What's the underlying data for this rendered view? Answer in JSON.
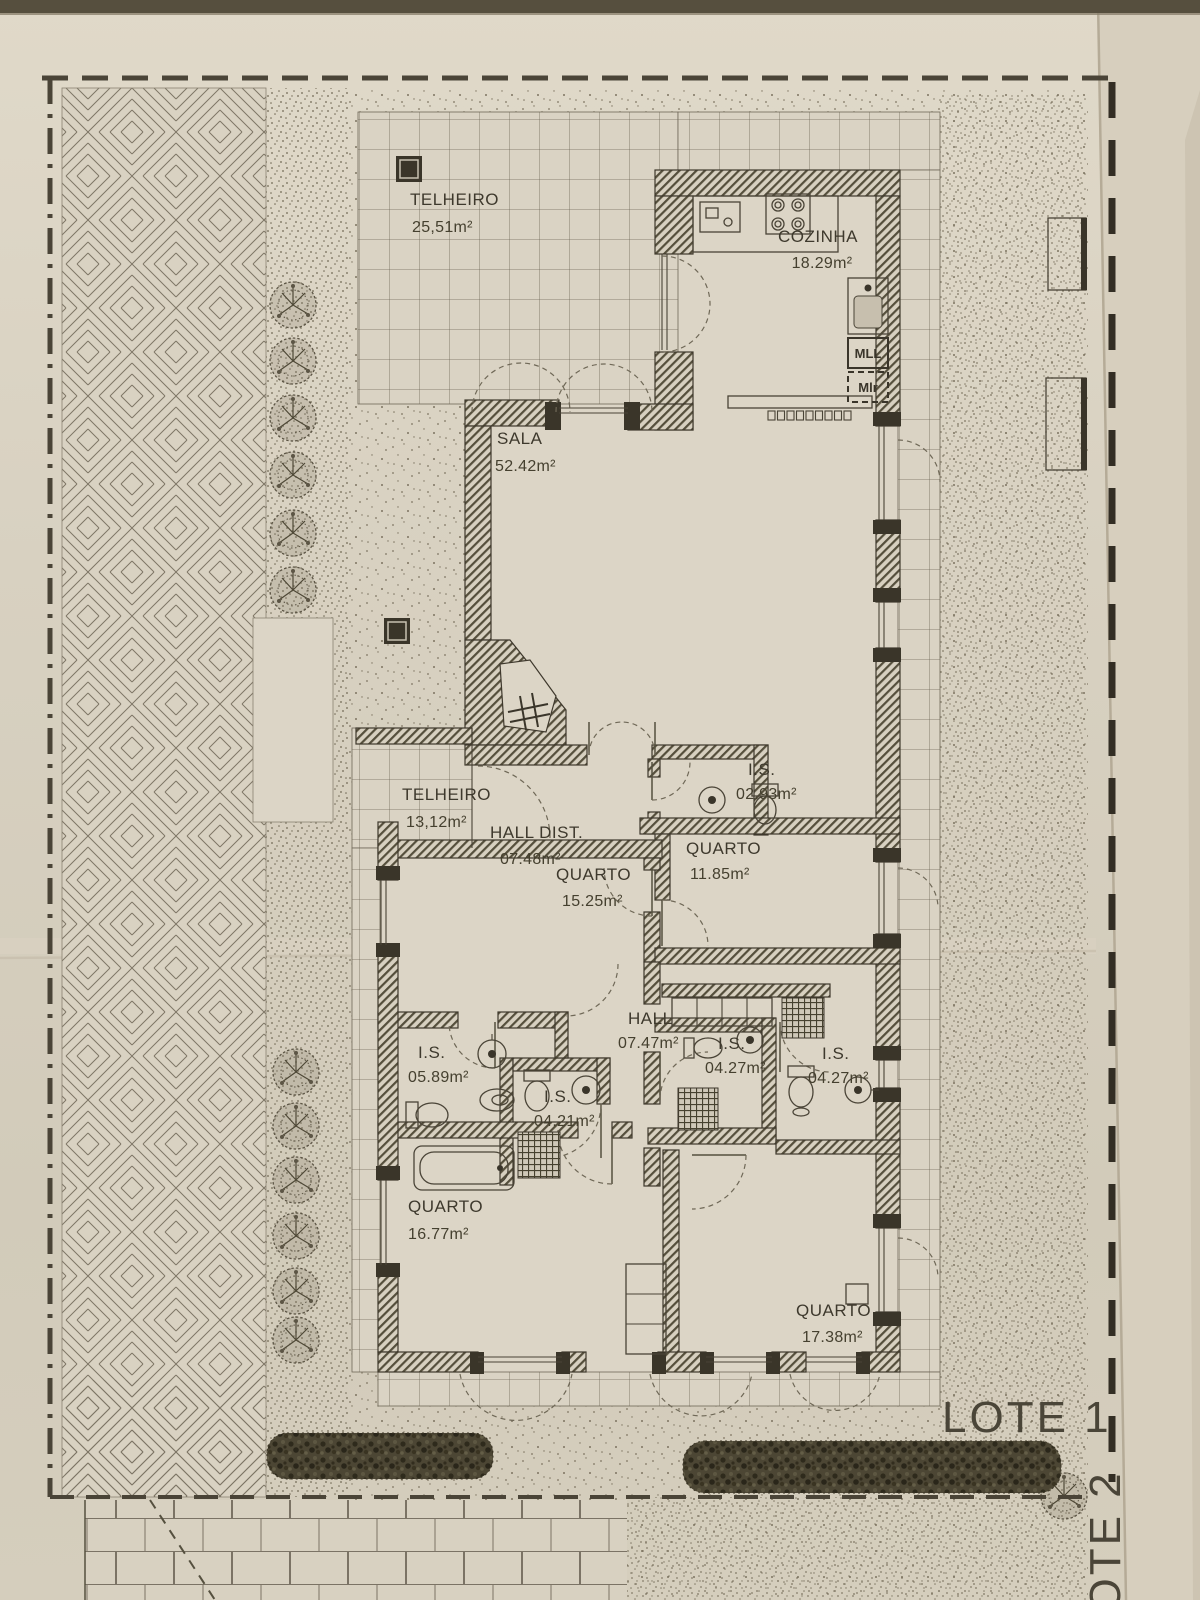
{
  "plan": {
    "rooms": [
      {
        "id": "telheiro_25",
        "name": "TELHEIRO",
        "area": "25,51m²"
      },
      {
        "id": "cozinha",
        "name": "COZINHA",
        "area": "18.29m²"
      },
      {
        "id": "sala",
        "name": "SALA",
        "area": "52.42m²"
      },
      {
        "id": "telheiro_13",
        "name": "TELHEIRO",
        "area": "13,12m²"
      },
      {
        "id": "hall_dist",
        "name": "HALL DIST.",
        "area": "07.48m²"
      },
      {
        "id": "is_02_93",
        "name": "I.S.",
        "area": "02.93m²"
      },
      {
        "id": "quarto_11_85",
        "name": "QUARTO",
        "area": "11.85m²"
      },
      {
        "id": "quarto_15_25",
        "name": "QUARTO",
        "area": "15.25m²"
      },
      {
        "id": "hall",
        "name": "HALL",
        "area": "07.47m²"
      },
      {
        "id": "is_05_89",
        "name": "I.S.",
        "area": "05.89m²"
      },
      {
        "id": "is_04_21",
        "name": "I.S.",
        "area": "04.21m²"
      },
      {
        "id": "is_04_27_left",
        "name": "I.S.",
        "area": "04.27m²"
      },
      {
        "id": "is_04_27_right",
        "name": "I.S.",
        "area": "04.27m²"
      },
      {
        "id": "quarto_16_77",
        "name": "QUARTO",
        "area": "16.77m²"
      },
      {
        "id": "quarto_17_38",
        "name": "QUARTO",
        "area": "17.38m²"
      }
    ],
    "appliances": [
      {
        "id": "mll",
        "label": "MLL"
      },
      {
        "id": "mlr",
        "label": "Mlr"
      }
    ],
    "lots": [
      {
        "id": "lote1",
        "label": "LOTE 1"
      },
      {
        "id": "lote2",
        "label": "LOTE 2"
      }
    ]
  },
  "colors": {
    "paper": "#d9d2c2",
    "ink": "#45402f",
    "wall_hatch": "#4e4836",
    "foliage_dark": "#3c3627",
    "boundary": "#352f25"
  }
}
